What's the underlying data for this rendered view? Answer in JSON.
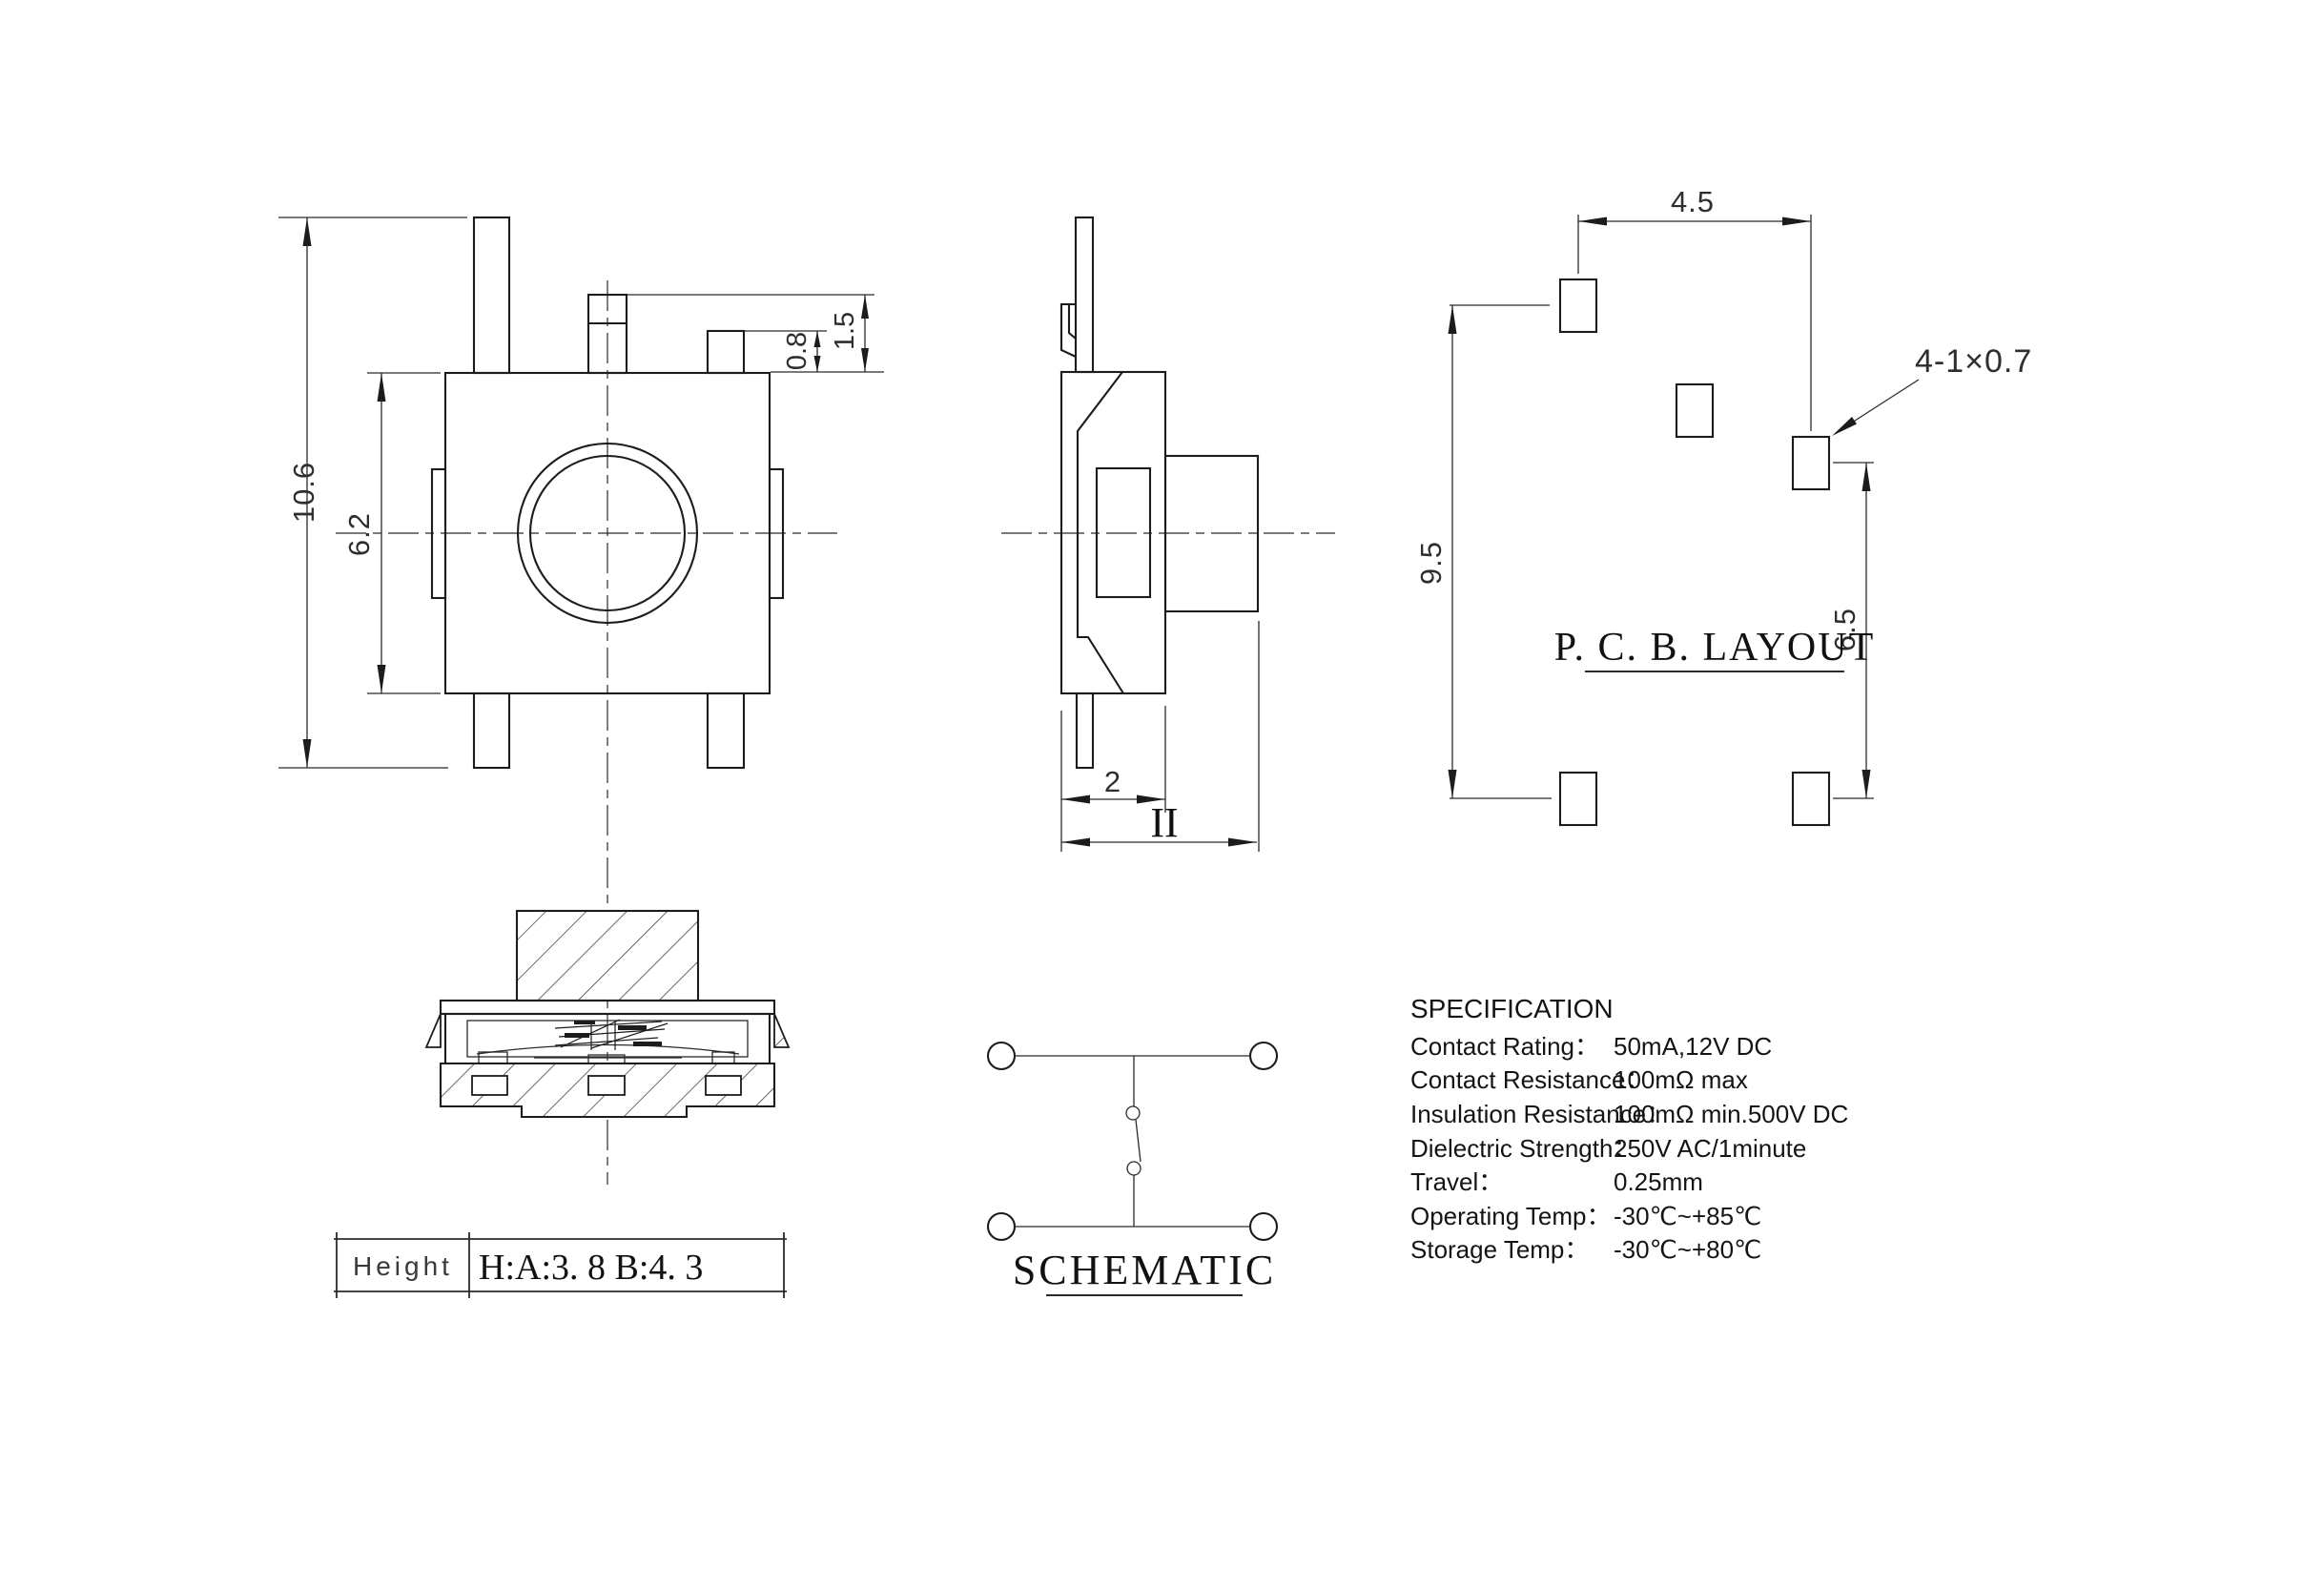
{
  "front_view": {
    "dim_overall_height": "10.6",
    "dim_body_height": "6.2",
    "dim_bump_height": "0.8",
    "dim_pin_height": "1.5"
  },
  "side_view": {
    "dim_body_depth": "2",
    "dim_total_width_label": "II"
  },
  "pcb_layout": {
    "title": "P. C. B. LAYOUT",
    "dim_horizontal_pitch": "4.5",
    "dim_vertical_pitch": "9.5",
    "dim_right_pitch": "6.5",
    "hole_callout": "4-1×0.7"
  },
  "schematic": {
    "title": "SCHEMATIC"
  },
  "height_table": {
    "label": "Height",
    "value": "H:A:3. 8 B:4. 3"
  },
  "specification": {
    "title": "SPECIFICATION",
    "rows": [
      {
        "label": "Contact  Rating：",
        "value": "50mA,12V DC"
      },
      {
        "label": "Contact  Resistance：",
        "value": "100mΩ max"
      },
      {
        "label": "Insulation Resistance：",
        "value": "100mΩ min.500V DC"
      },
      {
        "label": "Dielectric  Strength：",
        "value": "250V AC/1minute"
      },
      {
        "label": "Travel：",
        "value": "0.25mm"
      },
      {
        "label": "Operating Temp：",
        "value": "-30℃~+85℃"
      },
      {
        "label": "Storage Temp：",
        "value": "-30℃~+80℃"
      }
    ]
  }
}
